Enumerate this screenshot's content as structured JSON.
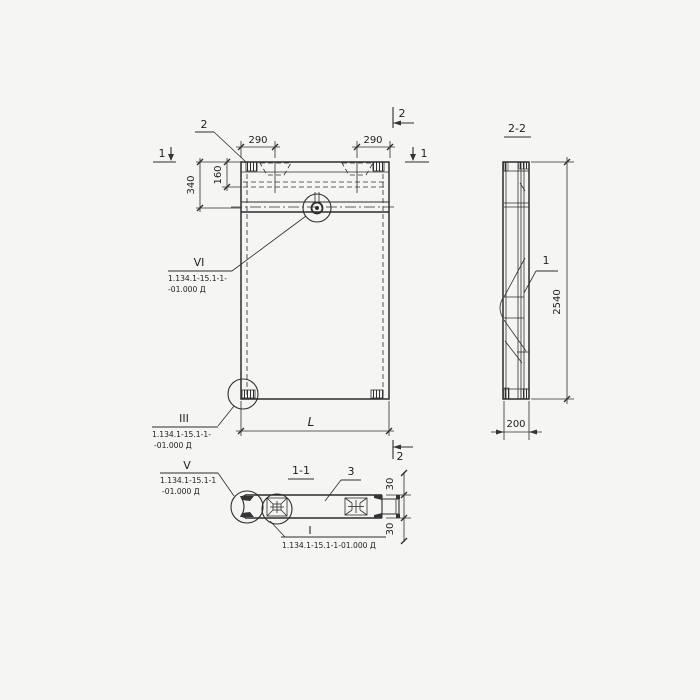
{
  "colors": {
    "paper": "#f5f5f3",
    "ink": "#2d2d2d"
  },
  "front_view": {
    "marker_1_left": "1",
    "marker_1_right": "1",
    "marker_2_top": "2",
    "marker_2_right": "2",
    "marker_2_bottom": "2",
    "dim_290_left": "290",
    "dim_290_right": "290",
    "dim_160": "160",
    "dim_340": "340",
    "dim_length": "L"
  },
  "side_view": {
    "title": "2-2",
    "item_1": "1",
    "dim_height": "2540",
    "dim_width": "200"
  },
  "bottom_view": {
    "title": "1-1",
    "item_3": "3",
    "dim_30_top": "30",
    "dim_30_bottom": "30"
  },
  "callouts": {
    "vi": {
      "label": "VI",
      "line1": "1.134.1-15.1-1-",
      "line2": "-01.000 Д"
    },
    "iii": {
      "label": "III",
      "line1": "1.134.1-15.1-1-",
      "line2": "-01.000 Д"
    },
    "v": {
      "label": "V",
      "line1": "1.134.1-15.1-1",
      "line2": "-01.000 Д"
    },
    "i": {
      "label": "I",
      "line1": "1.134.1-15.1-1-01.000 Д"
    }
  }
}
